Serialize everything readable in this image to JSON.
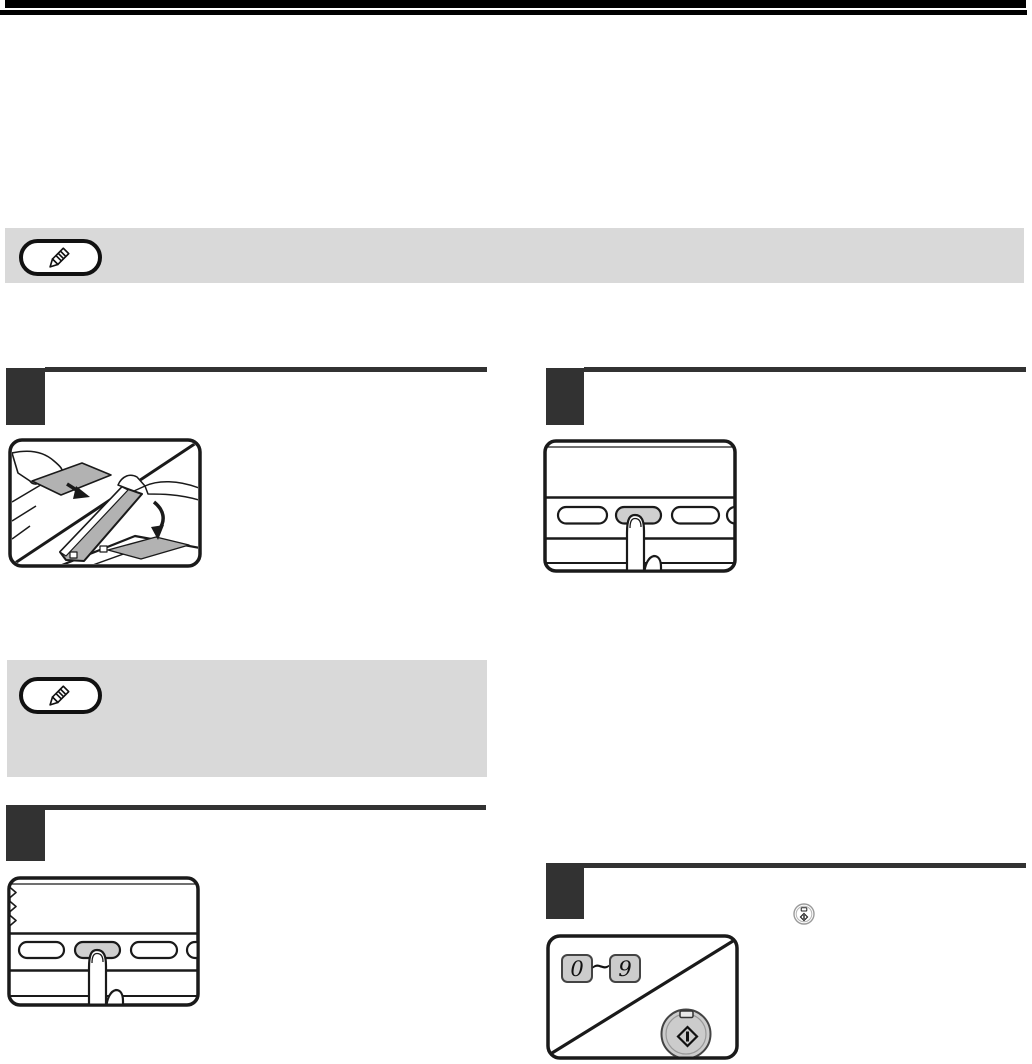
{
  "colors": {
    "page_bg": "#ffffff",
    "top_bar": "#000000",
    "note_box_bg": "#d9d9d9",
    "step_marker": "#323232",
    "rule": "#323232",
    "ink": "#111111",
    "line_art": "#1a1a1a",
    "key_fill": "#cccccc",
    "pressed_key_fill": "#cfcfcf",
    "sheet_gray": "#b2b2b2"
  },
  "note_boxes": [
    {
      "icon": "pencil-icon"
    },
    {
      "icon": "pencil-icon"
    }
  ],
  "steps": [
    {
      "id": "step-1",
      "column": "left"
    },
    {
      "id": "step-2",
      "column": "right"
    },
    {
      "id": "step-3",
      "column": "left"
    },
    {
      "id": "step-4",
      "column": "right"
    }
  ],
  "numeric_key_range": {
    "low": "0",
    "separator": "~",
    "high": "9"
  },
  "icons": {
    "note_badge": "pencil-icon",
    "inline_start_key": "start-key-icon",
    "start_button": "start-button-icon",
    "finger_press": "finger-press-icon",
    "feed_arrow": "down-right-arrow-icon",
    "close_cover_arrow": "curved-down-arrow-icon"
  }
}
